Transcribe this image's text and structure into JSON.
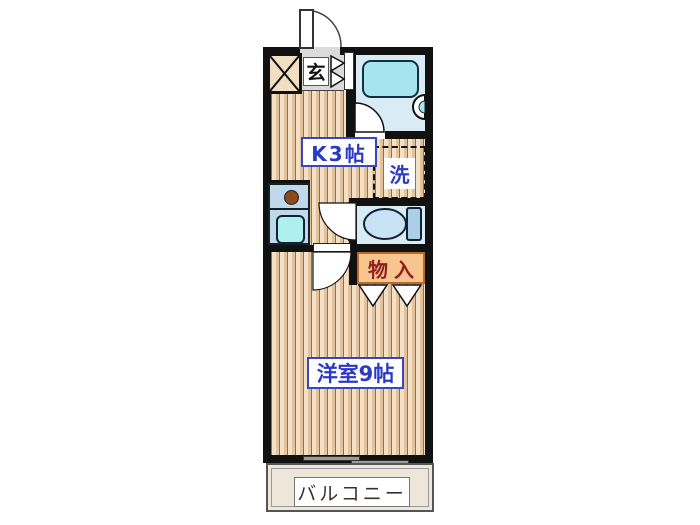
{
  "plan": {
    "type": "apartment-floor-plan",
    "rooms": {
      "genkan": {
        "label": "玄"
      },
      "kitchen": {
        "label": "K3帖"
      },
      "laundry": {
        "label": "洗"
      },
      "storage": {
        "label": "物入"
      },
      "western_room": {
        "label": "洋室9帖"
      },
      "balcony": {
        "label": "バルコニー"
      }
    },
    "fixtures": [
      "entrance-door",
      "bathtub",
      "wash-basin",
      "toilet",
      "kitchen-sink",
      "burner",
      "pipe-space",
      "folding-door",
      "closet-doors",
      "sliding-window"
    ],
    "colors": {
      "wall": "#111111",
      "floor_light": "#F3E1C7",
      "floor_stripe": "#E3C29C",
      "floor_line": "#8D7356",
      "water_room_floor": "#D9ECF6",
      "bathtub": "#A6E4F0",
      "counter": "#BFD9EA",
      "sink": "#AEEFF0",
      "burner": "#8A4A1E",
      "toilet_bowl": "#C9E2F4",
      "toilet_tank": "#A9D0E8",
      "storage_fill": "#F8C58F",
      "storage_border": "#B86A28",
      "storage_text": "#8F1F1F",
      "label_blue": "#2B39C5",
      "genkan_gray": "#DBDBDB",
      "balcony_fill": "#EDE6D9",
      "balcony_text": "#333333"
    }
  }
}
